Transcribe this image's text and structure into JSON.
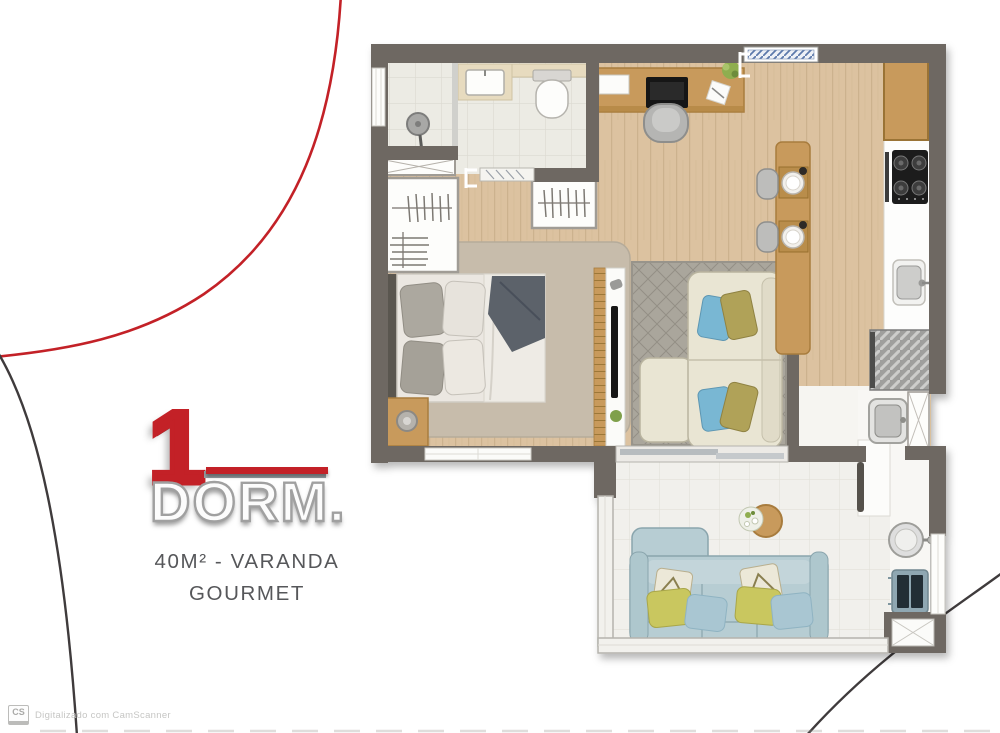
{
  "logo": {
    "number": "1",
    "word": "DORM.",
    "subtitle_line1": "40M² - VARANDA",
    "subtitle_line2": "GOURMET"
  },
  "scanner": {
    "badge": "CS",
    "text": "Digitalizado com CamScanner"
  },
  "colors": {
    "accent_red": "#c32127",
    "logo_stroke": "#a0a0a0",
    "text_gray": "#56575a",
    "wall": "#6e6862",
    "wood_floor": "#dcc2a0",
    "wood_grain": "#ccb28e",
    "wood_furniture": "#c89a5c",
    "wood_dark": "#a87c3e",
    "tile": "#ecebe4",
    "tile_line": "#dbdad1",
    "tile_balcony": "#f1f0ec",
    "rug_bedroom": "#c7bcab",
    "rug_living": "#aaa69c",
    "bed_linen": "#ebe7e1",
    "blanket": "#5b626b",
    "sofa_cream": "#e9e5d3",
    "sofa_blue": "#b7cdd3",
    "pillow_green": "#c9c75f",
    "pillow_lblue": "#a9c6d2",
    "pillow_blue": "#79b7d3",
    "pillow_olive": "#b0a258",
    "appliance_black": "#1d1d1d",
    "washer_blue": "#8fa7b2",
    "washer_dark": "#232e36",
    "metal": "#9f9f9d",
    "glass": "#cfcfca",
    "label_blue": "#5c79ab",
    "arc_dark": "#3f3b3c"
  }
}
